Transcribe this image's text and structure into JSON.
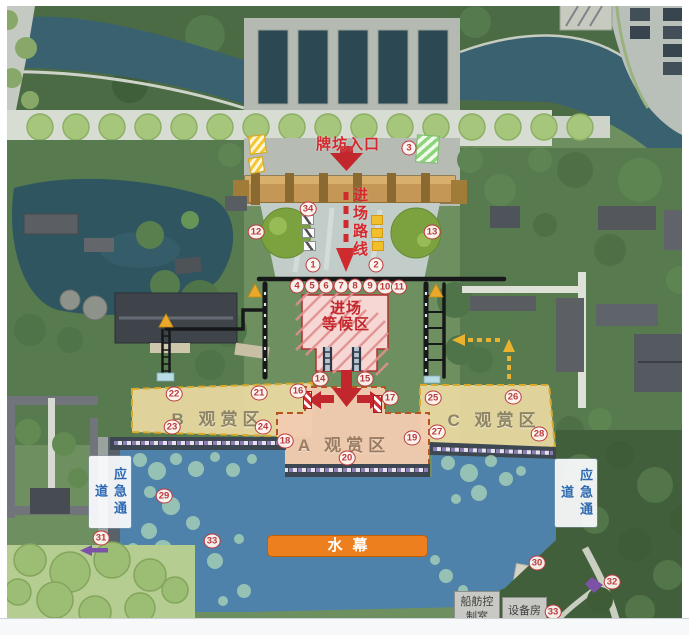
{
  "labels": {
    "entrance": "牌坊入口",
    "route": "进场路线",
    "waiting1": "进场",
    "waiting2": "等候区",
    "zoneB": "B 观赏区",
    "zoneA": "A 观赏区",
    "zoneC": "C 观赏区",
    "emergencyLeft": "应急通道",
    "emergencyRight": "应急通道",
    "waterCurtain": "水幕",
    "controlRoom1": "船舫控",
    "controlRoom2": "制室",
    "equipmentRoom": "设备房"
  },
  "markers": [
    {
      "n": "1",
      "x": 313,
      "y": 265
    },
    {
      "n": "2",
      "x": 376,
      "y": 265
    },
    {
      "n": "3",
      "x": 409,
      "y": 148
    },
    {
      "n": "4",
      "x": 297,
      "y": 286
    },
    {
      "n": "5",
      "x": 312,
      "y": 286
    },
    {
      "n": "6",
      "x": 326,
      "y": 286
    },
    {
      "n": "7",
      "x": 341,
      "y": 286
    },
    {
      "n": "8",
      "x": 355,
      "y": 286
    },
    {
      "n": "9",
      "x": 370,
      "y": 286
    },
    {
      "n": "10",
      "x": 385,
      "y": 287
    },
    {
      "n": "11",
      "x": 399,
      "y": 287
    },
    {
      "n": "12",
      "x": 256,
      "y": 232
    },
    {
      "n": "13",
      "x": 432,
      "y": 232
    },
    {
      "n": "14",
      "x": 320,
      "y": 379
    },
    {
      "n": "15",
      "x": 365,
      "y": 379
    },
    {
      "n": "16",
      "x": 298,
      "y": 391
    },
    {
      "n": "17",
      "x": 390,
      "y": 398
    },
    {
      "n": "18",
      "x": 285,
      "y": 441
    },
    {
      "n": "19",
      "x": 412,
      "y": 438
    },
    {
      "n": "20",
      "x": 347,
      "y": 458
    },
    {
      "n": "21",
      "x": 259,
      "y": 393
    },
    {
      "n": "22",
      "x": 174,
      "y": 394
    },
    {
      "n": "23",
      "x": 172,
      "y": 427
    },
    {
      "n": "24",
      "x": 263,
      "y": 427
    },
    {
      "n": "25",
      "x": 433,
      "y": 398
    },
    {
      "n": "26",
      "x": 513,
      "y": 397
    },
    {
      "n": "27",
      "x": 437,
      "y": 432
    },
    {
      "n": "28",
      "x": 539,
      "y": 434
    },
    {
      "n": "29",
      "x": 164,
      "y": 496
    },
    {
      "n": "30",
      "x": 537,
      "y": 563
    },
    {
      "n": "31",
      "x": 101,
      "y": 538
    },
    {
      "n": "32",
      "x": 612,
      "y": 582
    },
    {
      "n": "33",
      "x": 212,
      "y": 541
    },
    {
      "n": "33",
      "x": 553,
      "y": 612
    },
    {
      "n": "34",
      "x": 308,
      "y": 209
    }
  ],
  "colors": {
    "marker_red": "#bb3a3e",
    "route_red": "#cf2b2f",
    "zone_yellow": "#ead9a1",
    "zone_pink": "#f2cbb1",
    "waiting_hatch_pink": "#e89a9a",
    "water_curtain_bg": "#ed7f1f",
    "emergency_text_blue": "#2d6ab2",
    "lake_blue": "#4e82aa",
    "canal_teal": "#3a616f",
    "wall_black": "#17181a",
    "arrow_yellow": "#eaa92c",
    "purple_accent": "#7b52a6"
  }
}
